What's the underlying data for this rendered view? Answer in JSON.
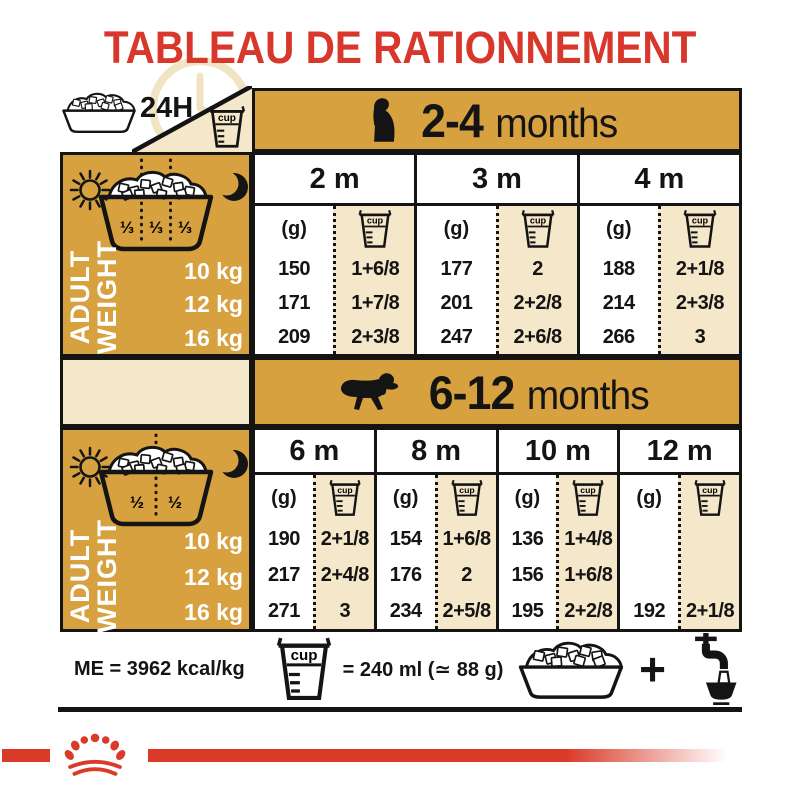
{
  "title": "TABLEAU DE RATIONNEMENT",
  "colors": {
    "gold": "#d7a140",
    "cream": "#f5e7c9",
    "red": "#d8382b",
    "bar_red": "#da3a28"
  },
  "corner": {
    "daily_label": "24H"
  },
  "units": {
    "g_label": "(g)",
    "cup_label": "cup"
  },
  "table1": {
    "age_range": "2-4",
    "age_word": "months",
    "portions": [
      "⅓",
      "⅓",
      "⅓"
    ],
    "side_label_line1": "ADULT",
    "side_label_line2": "WEIGHT",
    "weights": [
      "10 kg",
      "12 kg",
      "16 kg"
    ],
    "columns": [
      {
        "label": "2 m",
        "g": [
          "150",
          "171",
          "209"
        ],
        "cup": [
          "1+6/8",
          "1+7/8",
          "2+3/8"
        ]
      },
      {
        "label": "3 m",
        "g": [
          "177",
          "201",
          "247"
        ],
        "cup": [
          "2",
          "2+2/8",
          "2+6/8"
        ]
      },
      {
        "label": "4 m",
        "g": [
          "188",
          "214",
          "266"
        ],
        "cup": [
          "2+1/8",
          "2+3/8",
          "3"
        ]
      }
    ]
  },
  "table2": {
    "age_range": "6-12",
    "age_word": "months",
    "portions": [
      "½",
      "½"
    ],
    "side_label_line1": "ADULT",
    "side_label_line2": "WEIGHT",
    "weights": [
      "10 kg",
      "12 kg",
      "16 kg"
    ],
    "columns": [
      {
        "label": "6 m",
        "g": [
          "190",
          "217",
          "271"
        ],
        "cup": [
          "2+1/8",
          "2+4/8",
          "3"
        ]
      },
      {
        "label": "8 m",
        "g": [
          "154",
          "176",
          "234"
        ],
        "cup": [
          "1+6/8",
          "2",
          "2+5/8"
        ]
      },
      {
        "label": "10 m",
        "g": [
          "136",
          "156",
          "195"
        ],
        "cup": [
          "1+4/8",
          "1+6/8",
          "2+2/8"
        ]
      },
      {
        "label": "12 m",
        "g": [
          "",
          "",
          "192"
        ],
        "cup": [
          "",
          "",
          "2+1/8"
        ]
      }
    ]
  },
  "footer": {
    "energy": "ME = 3962 kcal/kg",
    "cup_equiv": "= 240 ml (≃ 88 g)",
    "plus": "+"
  }
}
